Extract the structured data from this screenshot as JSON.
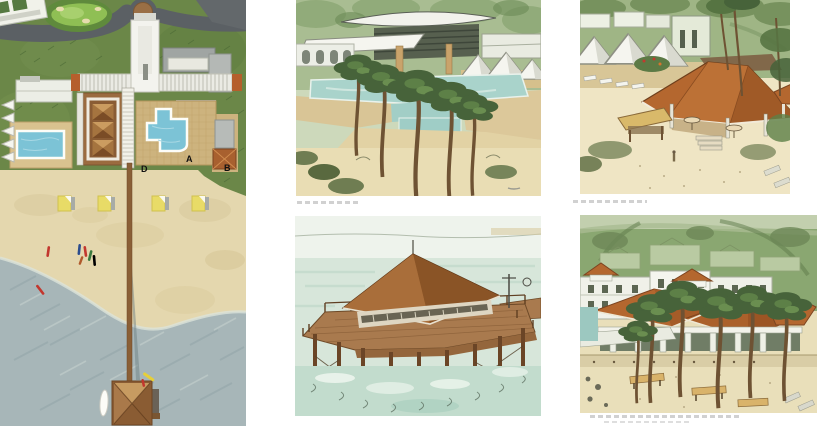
{
  "page": {
    "background": "#ffffff"
  },
  "site_plan": {
    "type": "beach-resort-site-plan",
    "markers": [
      {
        "label": "D"
      },
      {
        "label": "A"
      },
      {
        "label": "B"
      }
    ],
    "features": [
      "golf-green",
      "access-road",
      "arrival-court",
      "guest-wings",
      "main-roof-pavilion",
      "lap-pool",
      "free-form-pool",
      "beach-cabanas",
      "kayaks",
      "long-pier",
      "pier-end-pavilion"
    ],
    "colors": {
      "grass": "#6B8748",
      "road": "#5B6064",
      "sand": "#E4D7AE",
      "water": "#A7B6B8",
      "pool": "#7CC3D6",
      "roof_brown": "#9B6B3F",
      "accent_orange": "#B55F2C",
      "cabana_yellow": "#E8DB67"
    }
  },
  "sketches": [
    {
      "id": "pool-terrace-perspective",
      "caption_text_legible": false
    },
    {
      "id": "beach-pavilion-perspective",
      "caption_text_legible": false
    },
    {
      "id": "pier-pavilion-perspective",
      "caption_text_legible": false
    },
    {
      "id": "beachfront-buildings-perspective",
      "caption_text_legible": false
    }
  ]
}
